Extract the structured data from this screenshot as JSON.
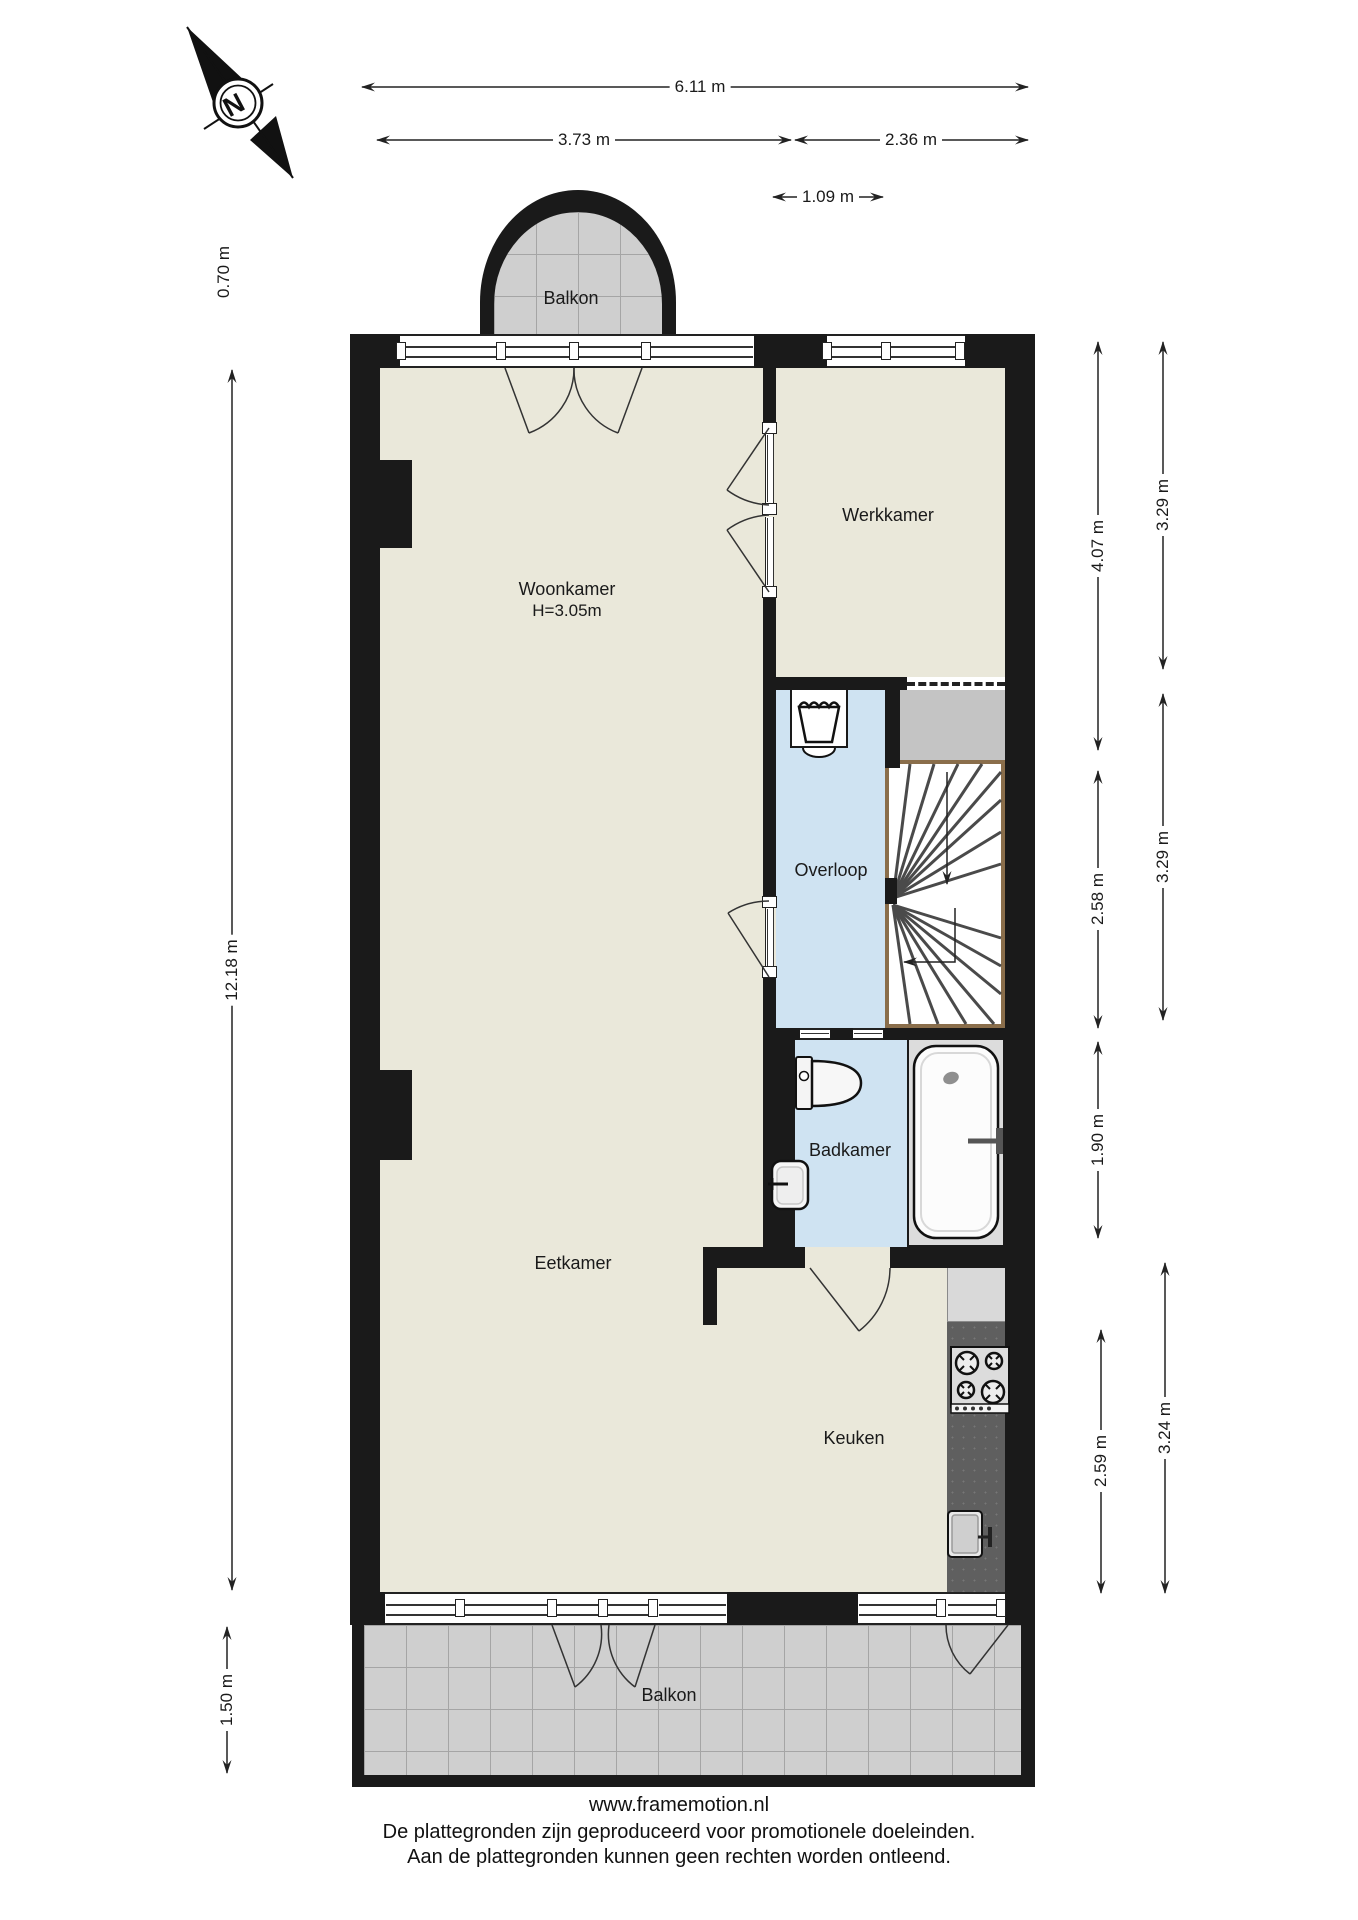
{
  "compass": {
    "north_label": "N"
  },
  "dimensions": {
    "top_total": "6.11 m",
    "top_left": "3.73 m",
    "top_right": "2.36 m",
    "top_window": "1.09 m",
    "left_balcony": "0.70 m",
    "left_total": "12.18 m",
    "left_balcony_bottom": "1.50 m",
    "right_werkkamer": "4.07 m",
    "right_overloop": "2.58 m",
    "right_badkamer": "1.90 m",
    "right_keuken_inner": "2.59 m",
    "right_outer_top": "3.29 m",
    "right_outer_mid": "3.29 m",
    "right_outer_bottom": "3.24 m"
  },
  "rooms": {
    "balcony_top": "Balkon",
    "living": "Woonkamer",
    "living_ceiling": "H=3.05m",
    "work": "Werkkamer",
    "landing": "Overloop",
    "bathroom": "Badkamer",
    "dining": "Eetkamer",
    "kitchen": "Keuken",
    "balcony_bottom": "Balkon"
  },
  "footer": {
    "website": "www.framemotion.nl",
    "disclaimer_line1": "De plattegronden zijn geproduceerd voor promotionele doeleinden.",
    "disclaimer_line2": "Aan de plattegronden kunnen geen rechten worden ontleend."
  },
  "colors": {
    "wall": "#1a1a1a",
    "floor": "#eae8da",
    "wet_floor": "#cfe3f2",
    "tile": "#cfcfcf",
    "closet": "#c4c4c4",
    "counter": "#5f5f5f",
    "stair_border": "#8a6e4b"
  }
}
